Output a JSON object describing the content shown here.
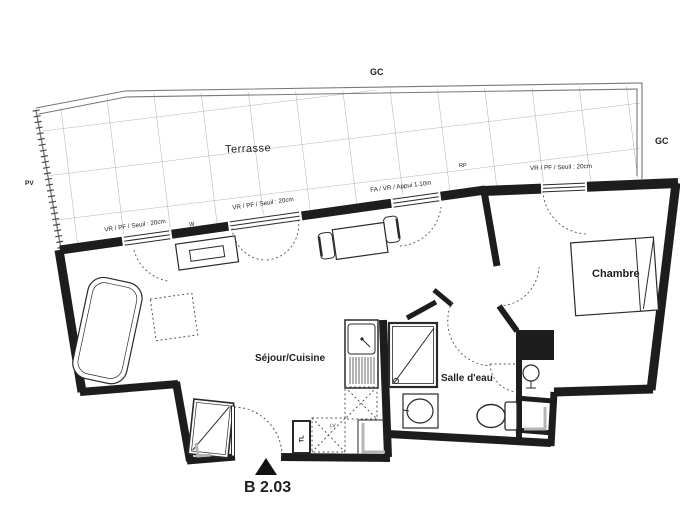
{
  "labels": {
    "terrace": "Terrasse",
    "living_kitchen": "Séjour/Cuisine",
    "bedroom": "Chambre",
    "bathroom": "Salle d'eau",
    "unit": "B 2.03",
    "gc_top": "GC",
    "gc_right": "GC",
    "pv": "PV",
    "rp": "RP",
    "window_label_left": "VR / PF / Seuil : 20cm",
    "window_label_mid": "VR / PF / Seuil : 20cm",
    "window_label_bay": "FA / VR / Appui 1.10m",
    "window_label_bedroom": "VR / PF / Seuil : 20cm",
    "washer_box": "TL",
    "appliance_box": "LV",
    "vent_mark": "W"
  },
  "colors": {
    "wall": "#1d1d1d",
    "line": "#2a2a2a",
    "grid": "#9b9b9b",
    "dash": "#555555",
    "shadow": "#b5b5b5",
    "paper": "#ffffff"
  }
}
